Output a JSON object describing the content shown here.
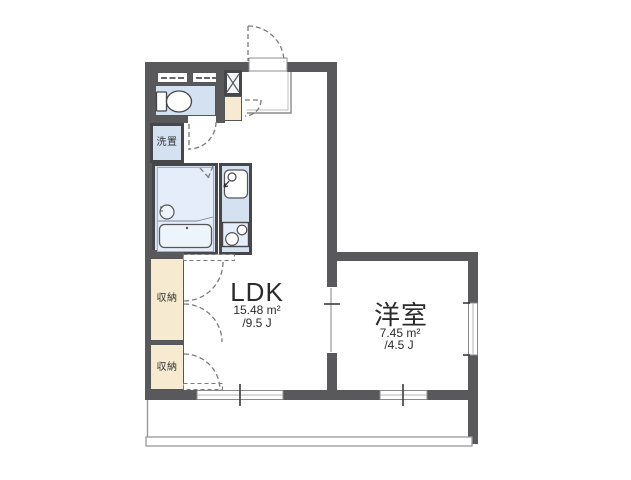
{
  "title": "1LDK apartment floor plan",
  "colors": {
    "wall": "#59595c",
    "wallDark": "#47474a",
    "wet": "#d3e1f1",
    "wetLight": "#e4edf9",
    "beige": "#f6ebd1",
    "line": "#999999",
    "dash": "#7a7a7a",
    "ink": "#2b2b2b"
  },
  "rooms": {
    "ldk": {
      "label": "LDK",
      "area_m2": "15.48 m²",
      "area_jo": "/9.5 J"
    },
    "western": {
      "label": "洋室",
      "area_m2": "7.45 m²",
      "area_jo": "/4.5 J"
    },
    "storage_upper": {
      "label": "収納"
    },
    "storage_lower": {
      "label": "収納"
    },
    "laundry": {
      "label": "洗置"
    }
  }
}
